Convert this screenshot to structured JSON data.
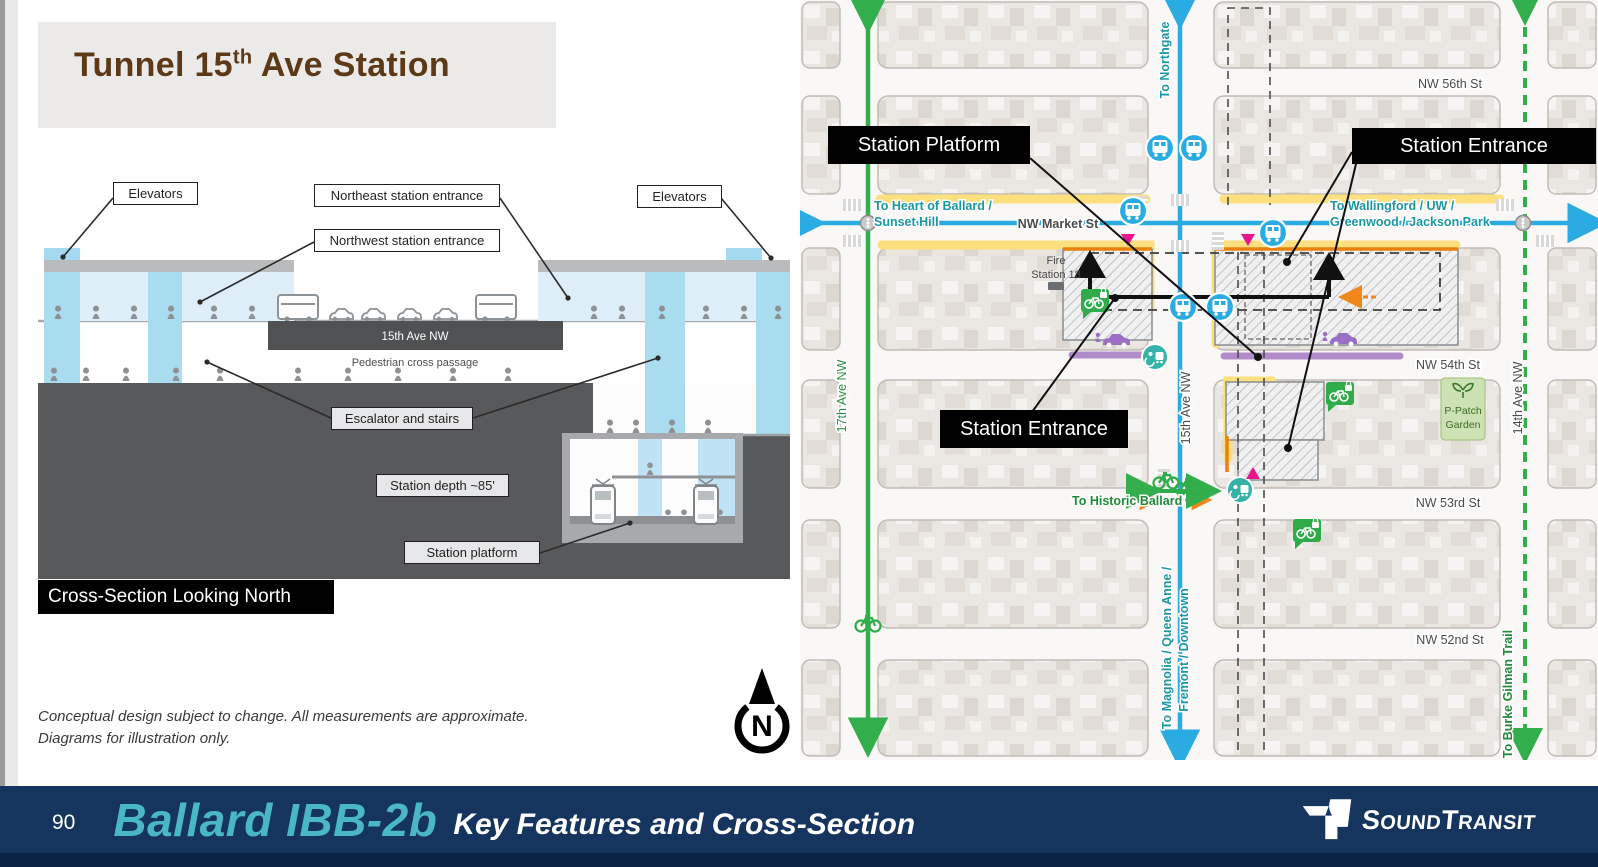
{
  "slide": {
    "title_part1": "Tunnel 15",
    "title_sup": "th",
    "title_part2": " Ave Station",
    "disclaimer_line1": "Conceptual design subject to change. All measurements are approximate.",
    "disclaimer_line2": "Diagrams for illustration only."
  },
  "cross_section": {
    "labels": {
      "elevators_left": "Elevators",
      "northeast_entrance": "Northeast station entrance",
      "northwest_entrance": "Northwest station entrance",
      "elevators_right": "Elevators",
      "escalator_stairs": "Escalator and stairs",
      "station_depth": "Station depth ~85'",
      "station_platform": "Station platform",
      "street": "15th Ave NW",
      "pedestrian_passage": "Pedestrian cross passage",
      "caption": "Cross-Section Looking North"
    }
  },
  "map": {
    "callouts": {
      "station_platform": "Station Platform",
      "station_entrance_ne": "Station Entrance",
      "station_entrance_sw": "Station Entrance"
    },
    "streets": {
      "nw_56th": "NW 56th St",
      "nw_market": "NW Market St",
      "nw_54th": "NW 54th St",
      "nw_53rd": "NW 53rd St",
      "nw_52nd": "NW 52nd St",
      "ave_15th": "15th Ave NW",
      "ave_17th": "17th Ave NW",
      "ave_14th": "14th Ave NW"
    },
    "directions": {
      "to_northgate": "To Northgate",
      "to_heart_of_ballard": "To Heart of Ballard /",
      "sunset_hill": "Sunset Hill",
      "to_wallingford": "To Wallingford / UW /",
      "greenwood_jackson": "Greenwood / Jackson Park",
      "to_magnolia": "To Magnolia / Queen Anne /",
      "fremont_downtown": "Fremont / Downtown",
      "to_historic_ballard": "To Historic Ballard",
      "to_burke_gilman": "To Burke Gilman Trail"
    },
    "pois": {
      "fire_station_line1": "Fire",
      "fire_station_line2": "Station 18",
      "p_patch_line1": "P-Patch",
      "p_patch_line2": "Garden"
    },
    "north_label": "N"
  },
  "footer": {
    "page_number": "90",
    "title_highlight": "Ballard IBB-2b",
    "title_rest": "Key Features and Cross-Section",
    "logo_s1": "S",
    "logo_s2": "OUND",
    "logo_t1": "T",
    "logo_t2": "RANSIT"
  },
  "colors": {
    "navy": "#16355e",
    "teal_accent": "#49b8c4",
    "title_brown": "#5c3a17",
    "map_blue": "#2aabe2",
    "map_green": "#33ae4c",
    "map_teal_text": "#1b97a4",
    "magenta": "#e8148c",
    "orange": "#f0871c",
    "purple": "#9a6fc4",
    "yellow": "#fbe07d"
  }
}
